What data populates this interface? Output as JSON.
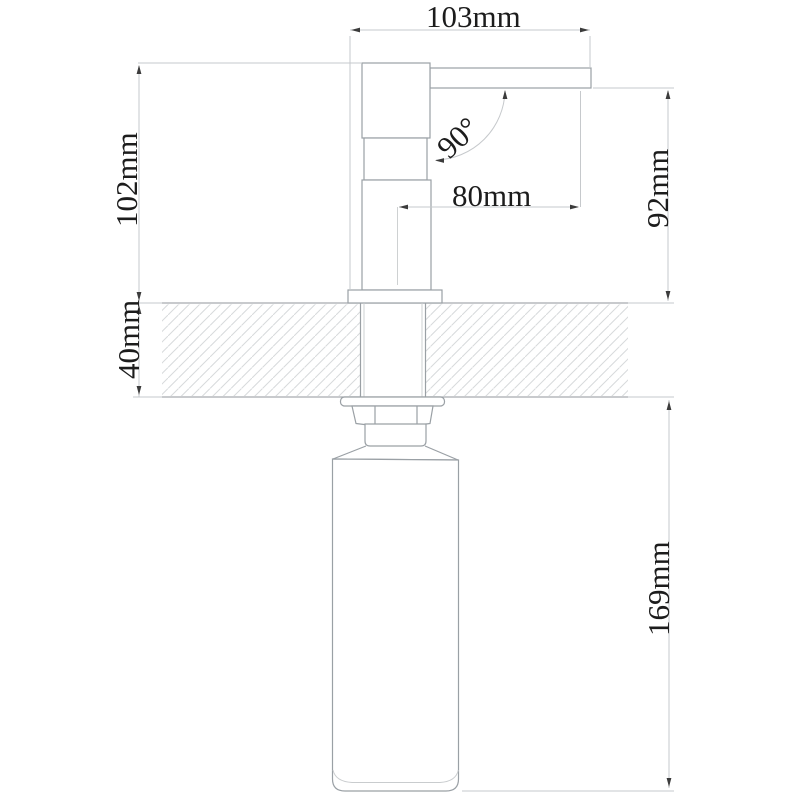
{
  "drawing": {
    "type": "technical-dimension-drawing",
    "subject": "deck-mounted soap dispenser, side section view",
    "colors": {
      "background": "#ffffff",
      "object_line": "#9aa0a5",
      "dimension_line": "#c6c9cc",
      "hatch_line": "#d7dadc",
      "text": "#1c1c1c"
    },
    "dimensions": {
      "spout_span_top": "103mm",
      "height_above_counter": "102mm",
      "counter_thickness": "40mm",
      "spout_clearance": "92mm",
      "under_counter_depth": "169mm",
      "spout_reach": "80mm",
      "spout_angle": "90°"
    }
  }
}
